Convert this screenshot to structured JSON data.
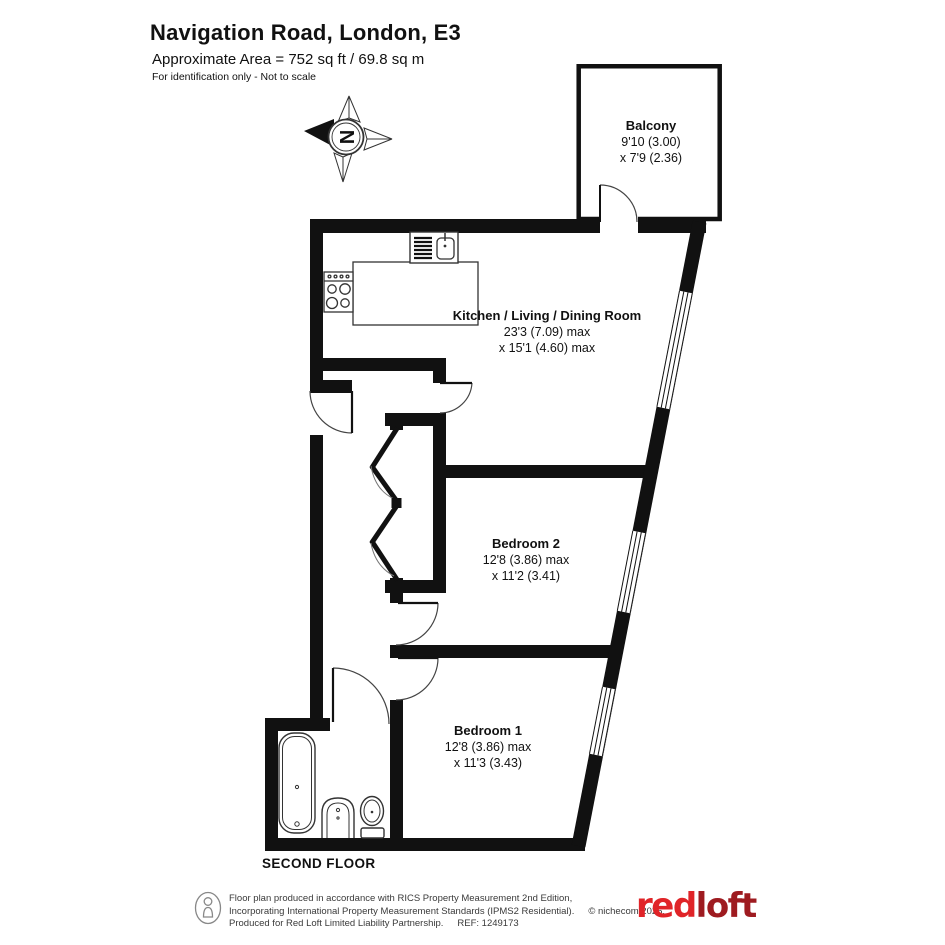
{
  "header": {
    "title": "Navigation Road, London, E3",
    "area": "Approximate Area = 752 sq ft / 69.8 sq m",
    "note": "For identification only - Not to scale"
  },
  "compass": {
    "north": "N"
  },
  "rooms": {
    "balcony": {
      "name": "Balcony",
      "dim1": "9'10 (3.00)",
      "dim2": "x 7'9 (2.36)"
    },
    "kitchen": {
      "name": "Kitchen / Living / Dining Room",
      "dim1": "23'3 (7.09) max",
      "dim2": "x 15'1 (4.60) max"
    },
    "bedroom2": {
      "name": "Bedroom 2",
      "dim1": "12'8 (3.86) max",
      "dim2": "x 11'2 (3.41)"
    },
    "bedroom1": {
      "name": "Bedroom 1",
      "dim1": "12'8 (3.86) max",
      "dim2": "x 11'3 (3.43)"
    }
  },
  "floor_label": "SECOND FLOOR",
  "footer": {
    "line1": "Floor plan produced in accordance with RICS Property Measurement 2nd Edition,",
    "line2": "Incorporating International Property Measurement Standards (IPMS2 Residential).",
    "copyright": "© nichecom 2025.",
    "line3": "Produced for Red Loft Limited Liability Partnership.",
    "ref": "REF:  1249173",
    "logo_red": "red",
    "logo_loft": "loft"
  }
}
